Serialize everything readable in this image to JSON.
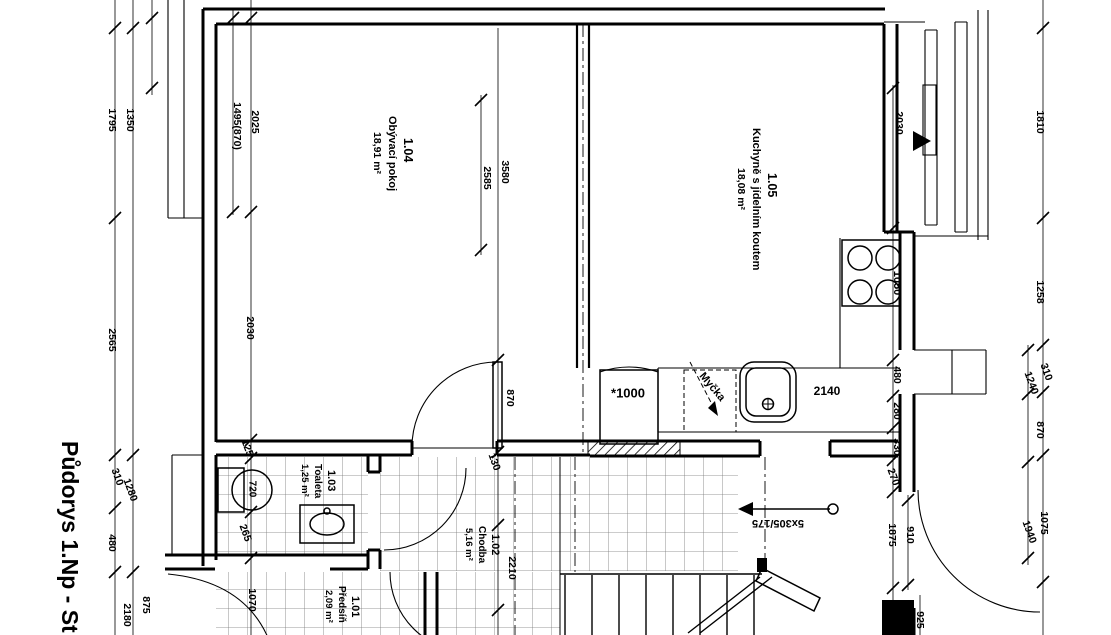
{
  "title": "Půdorys 1.Np - St",
  "rooms": [
    {
      "id": "1.04",
      "name": "Obývací pokoj",
      "area": "18,91 m²"
    },
    {
      "id": "1.05",
      "name": "Kuchyně s jídelním koutem",
      "area": "18,08 m²"
    },
    {
      "id": "1.03",
      "name": "Toaleta",
      "area": "1,25 m²"
    },
    {
      "id": "1.02",
      "name": "Chodba",
      "area": "5,16 m²"
    },
    {
      "id": "1.01",
      "name": "Předsíň",
      "area": "2,09 m²"
    }
  ],
  "dimension_labels": [
    {
      "v": "1795",
      "x": 112,
      "y": 120,
      "r": 90
    },
    {
      "v": "1350",
      "x": 130,
      "y": 120,
      "r": 90
    },
    {
      "v": "2565",
      "x": 112,
      "y": 340,
      "r": 90
    },
    {
      "v": "310",
      "x": 117,
      "y": 477,
      "r": 70
    },
    {
      "v": "1280",
      "x": 130,
      "y": 490,
      "r": 70
    },
    {
      "v": "480",
      "x": 112,
      "y": 543,
      "r": 90
    },
    {
      "v": "875",
      "x": 146,
      "y": 605,
      "r": 90
    },
    {
      "v": "2180",
      "x": 127,
      "y": 615,
      "r": 90
    },
    {
      "v": "2025",
      "x": 255,
      "y": 122,
      "r": 90
    },
    {
      "v": "1495(870)",
      "x": 237,
      "y": 126,
      "r": 90
    },
    {
      "v": "2030",
      "x": 250,
      "y": 328,
      "r": 90
    },
    {
      "v": "125",
      "x": 247,
      "y": 448,
      "r": 70
    },
    {
      "v": "265",
      "x": 245,
      "y": 533,
      "r": 70
    },
    {
      "v": "1070",
      "x": 252,
      "y": 600,
      "r": 90
    },
    {
      "v": "3580",
      "x": 505,
      "y": 172,
      "r": 90
    },
    {
      "v": "2585",
      "x": 487,
      "y": 178,
      "r": 90
    },
    {
      "v": "870",
      "x": 510,
      "y": 398,
      "r": 90
    },
    {
      "v": "130",
      "x": 494,
      "y": 462,
      "r": 70
    },
    {
      "v": "2210",
      "x": 512,
      "y": 568,
      "r": 90
    },
    {
      "v": "2030",
      "x": 899,
      "y": 123,
      "r": 90
    },
    {
      "v": "480",
      "x": 897,
      "y": 375,
      "r": 90
    },
    {
      "v": "280",
      "x": 897,
      "y": 411,
      "r": 90
    },
    {
      "v": "330",
      "x": 897,
      "y": 447,
      "r": 90
    },
    {
      "v": "270",
      "x": 893,
      "y": 477,
      "r": 70
    },
    {
      "v": "910",
      "x": 910,
      "y": 535,
      "r": 90
    },
    {
      "v": "1875",
      "x": 892,
      "y": 535,
      "r": 90
    },
    {
      "v": "925",
      "x": 920,
      "y": 620,
      "r": 90
    },
    {
      "v": "1810",
      "x": 1040,
      "y": 122,
      "r": 90
    },
    {
      "v": "1258",
      "x": 1040,
      "y": 292,
      "r": 90
    },
    {
      "v": "310",
      "x": 1046,
      "y": 372,
      "r": 70
    },
    {
      "v": "1240",
      "x": 1031,
      "y": 383,
      "r": 70
    },
    {
      "v": "870",
      "x": 1040,
      "y": 430,
      "r": 90
    },
    {
      "v": "1075",
      "x": 1044,
      "y": 523,
      "r": 90
    },
    {
      "v": "1940",
      "x": 1029,
      "y": 532,
      "r": 70
    }
  ],
  "annotation_labels": [
    {
      "v": "*1000",
      "x": 628,
      "y": 394,
      "r": 0,
      "s": 13
    },
    {
      "v": "2140",
      "x": 827,
      "y": 392,
      "r": 0,
      "s": 12
    },
    {
      "v": "Myčka",
      "x": 712,
      "y": 387,
      "r": 50,
      "s": 11
    },
    {
      "v": "1050",
      "x": 897,
      "y": 283,
      "r": 90,
      "s": 11
    },
    {
      "v": "720",
      "x": 252,
      "y": 489,
      "r": 90,
      "s": 10
    },
    {
      "v": "5x305/175",
      "x": 778,
      "y": 523,
      "r": 180,
      "s": 11
    }
  ]
}
